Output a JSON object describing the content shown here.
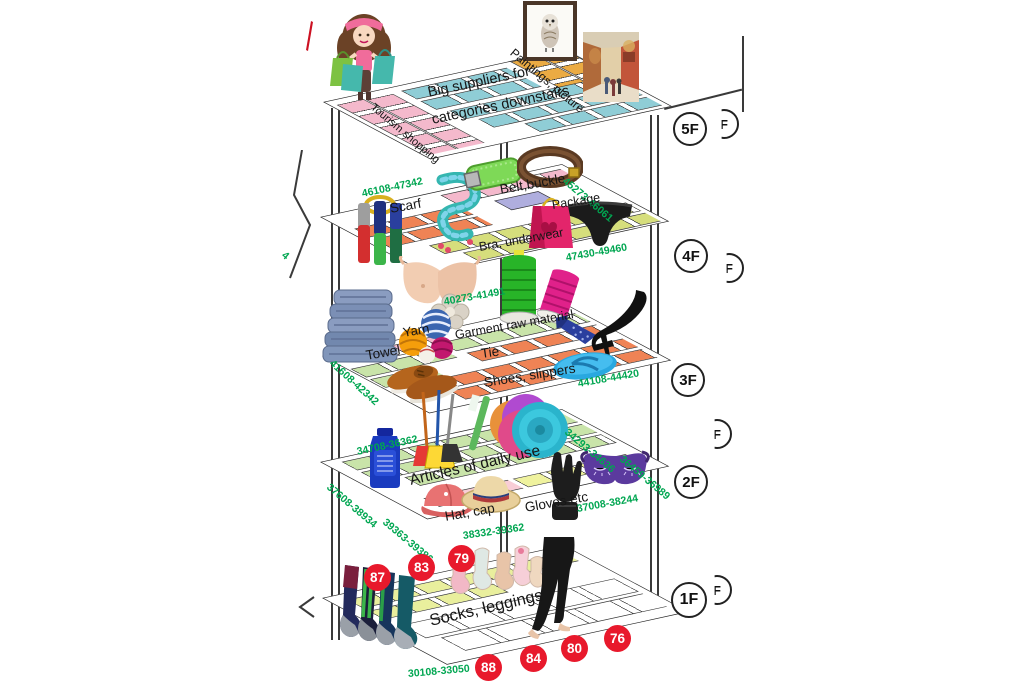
{
  "palette": {
    "green_text": "#00A651",
    "red_badge": "#E8192C",
    "cyan": "#8FCDD6",
    "pink": "#F4B9CC",
    "amber": "#EBAB43",
    "orange": "#EF8355",
    "lavender": "#AFAEDE",
    "yellow_green": "#D6DE7C",
    "light_green": "#C9E4A9",
    "pale_yellow": "#EFF29E",
    "pale_pink": "#F8CDD6",
    "floor_yellow": "#E9EF9D"
  },
  "floor_labels": {
    "f5": "5F",
    "f4": "4F",
    "f3": "3F",
    "f2": "2F",
    "f1": "1F",
    "partial": "F"
  },
  "f5": {
    "title1": "Big suppliers for",
    "title2": "categories downstairs",
    "left_wing": "Tourism shopping",
    "right_wing": "Paintings, picture"
  },
  "f4": {
    "areas": {
      "scarf": "Scarf",
      "belt": "Belt,buckle",
      "package": "Package",
      "bra": "Bra, underwear"
    },
    "ranges": {
      "left": "46108-47342",
      "right": "45273-46061",
      "bottom": "47430-49460"
    }
  },
  "f3": {
    "areas": {
      "towel": "Towel",
      "yarn": "Yarn",
      "garment": "Garment raw material",
      "tie": "Tie",
      "shoes": "Shoes, slippers"
    },
    "ranges": {
      "top": "40273-41491",
      "left": "41608-42342",
      "bottom": "44108-44420"
    }
  },
  "f2": {
    "areas": {
      "daily": "Articles of daily use",
      "hat": "Hat, cap",
      "gloves": "Gloves etc"
    },
    "ranges": {
      "top_left": "34708-36362",
      "top_right": "34293-34636",
      "right": "36459-36989",
      "bottom_right": "37008-38244",
      "bottom": "38332-39362",
      "left_lower": "39363-39386",
      "left_upper": "37608-38934"
    }
  },
  "f1": {
    "areas": {
      "socks": "Socks, leggings"
    },
    "ranges": {
      "bottom": "30108-33050"
    },
    "badges": [
      "87",
      "83",
      "79",
      "88",
      "84",
      "80",
      "76"
    ]
  },
  "fragments": {
    "left_cut_text": "4"
  },
  "images": [
    "shopping-girl",
    "owl-painting",
    "street-painting",
    "red-mark",
    "hanging-scarves",
    "teal-scarf",
    "green-belt",
    "brown-belt",
    "gift-bag",
    "black-underwear",
    "bra",
    "green-thread-spool",
    "pink-thread-spool",
    "lace-flower",
    "towel-stack",
    "yarn-balls",
    "blue-tie",
    "black-high-heel",
    "blue-flip-flop",
    "brown-shoes",
    "plate-stack",
    "green-toothbrush",
    "brooms",
    "blue-bottle",
    "red-cap",
    "straw-hat",
    "black-gloves",
    "purple-sleep-mask",
    "dark-socks",
    "baby-socks",
    "black-leggings"
  ]
}
